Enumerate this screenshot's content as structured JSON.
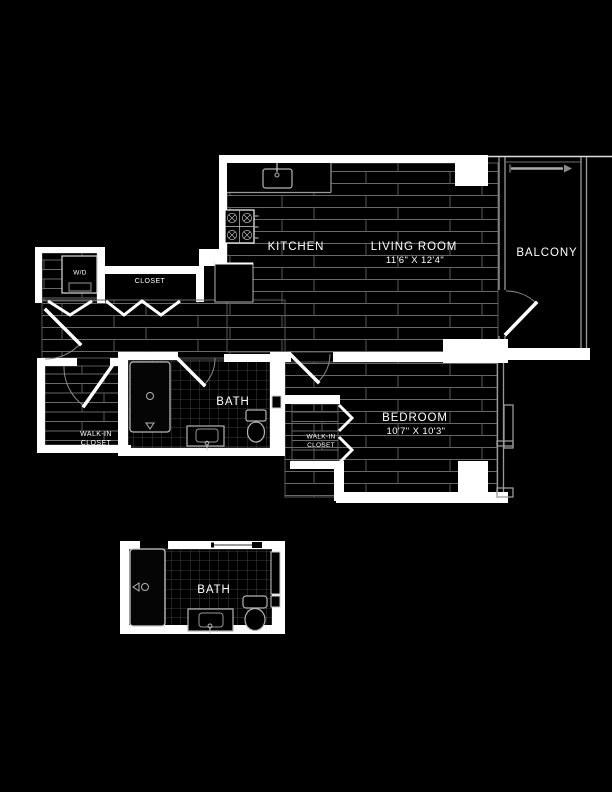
{
  "plan_title": "One-bedroom apartment floor plan",
  "colors": {
    "background": "#000000",
    "walls": "#ffffff",
    "floor_lines": "#6e6e6e",
    "tile_lines": "#4e4e4e",
    "fixture_lines": "#b5b5b5",
    "window_lines": "#9a9a9a"
  },
  "rooms": {
    "kitchen": {
      "label": "KITCHEN"
    },
    "living_room": {
      "label": "LIVING ROOM",
      "dimensions": "11'6\" X 12'4\""
    },
    "balcony": {
      "label": "BALCONY"
    },
    "bedroom": {
      "label": "BEDROOM",
      "dimensions": "10'7\" X 10'3\""
    },
    "bath": {
      "label": "BATH"
    },
    "bath_detail": {
      "label": "BATH"
    },
    "wd_closet": {
      "label": "W/D"
    },
    "hall_closet": {
      "label": "CLOSET"
    },
    "walk_in_closet": {
      "label_line1": "WALK-IN",
      "label_line2": "CLOSET"
    },
    "bedroom_walk_in_closet": {
      "label_line1": "WALK-IN",
      "label_line2": "CLOSET"
    }
  },
  "fixtures": {
    "stove": "stove-icon",
    "kitchen_sink": "sink-icon",
    "washer_dryer": "washer-dryer-icon",
    "shower": "shower-icon",
    "toilet": "toilet-icon",
    "vanity_sink": "vanity-sink-icon",
    "sliding_door": "sliding-door-icon",
    "towel_bar": "towel-bar-icon",
    "window": "window-icon"
  }
}
